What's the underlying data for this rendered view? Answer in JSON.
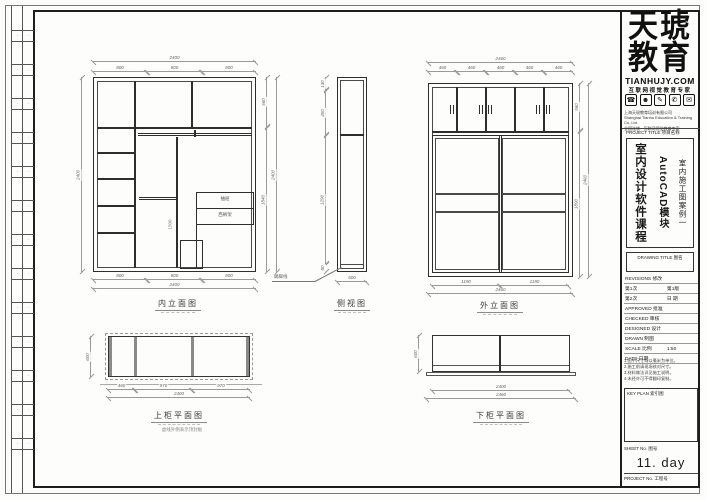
{
  "sheet": {
    "strip_mark": "·",
    "drawings": {
      "interior": {
        "label": "内立面图",
        "drawer": "抽屉",
        "rack": "西裤架",
        "dim_mid": "1500",
        "dim_top_total": "2400",
        "dim_top_segs": [
          "800",
          "800",
          "800"
        ],
        "dim_left_total": "2400",
        "dim_right_segs": [
          "560",
          "1840"
        ],
        "dim_right_total": "2400",
        "dim_bottom_segs": [
          "800",
          "800",
          "800"
        ],
        "dim_bottom_total": "2400"
      },
      "side": {
        "label": "侧视图",
        "note": "踢脚线",
        "dim_left_segs": [
          "130",
          "450",
          "1290",
          "80"
        ],
        "dim_bottom": "600"
      },
      "exterior": {
        "label": "外立面图",
        "dim_top_total": "2460",
        "dim_top_segs": [
          "460",
          "460",
          "460",
          "460",
          "460"
        ],
        "dim_right_segs": [
          "560",
          "1890"
        ],
        "dim_right_total": "2460",
        "dim_bottom_segs": [
          "1190",
          "1190"
        ],
        "dim_bottom_total": "2460"
      },
      "upper_plan": {
        "label": "上柜平面图",
        "note": "虚线外侧表示顶封板",
        "dim_left": "600",
        "dim_bottom_segs": [
          "460",
          "970",
          "970"
        ],
        "dim_bottom_total": "2400"
      },
      "lower_plan": {
        "label": "下柜平面图",
        "dim_left": "600",
        "dim_bottom_inner": "2400",
        "dim_bottom_total": "2460"
      }
    }
  },
  "titleblock": {
    "brand": {
      "line1": "天琥",
      "line2": "教育",
      "site": "TIANHUJY.COM",
      "tagline": "互联网视觉教育专家",
      "icons": [
        "☎",
        "☻",
        "✎",
        "✆",
        "✉"
      ],
      "company": [
        "上海天琥教育培训有限公司",
        "Shanghai Tianhu Education & Training Co.,Ltd.",
        "全国连锁 · 互联网视觉教育专家"
      ]
    },
    "project_title_label": "PROJECT TITLE 项目名称",
    "project_lines": [
      "室内设计软件课程",
      "AutoCAD模块",
      "室内施工图案例一"
    ],
    "drawing_title_label": "DRAWING TITLE 图名",
    "fields": [
      {
        "l": "REVISIONS 修改",
        "r": ""
      },
      {
        "l": "第1次",
        "r": "第1版"
      },
      {
        "l": "第2次",
        "r": "日 期"
      },
      {
        "l": "APPROVED 批准",
        "r": ""
      },
      {
        "l": "CHECKED 审核",
        "r": ""
      },
      {
        "l": "DESIGNED 设计",
        "r": ""
      },
      {
        "l": "DRAWN 制图",
        "r": ""
      },
      {
        "l": "SCALE 比例",
        "r": "1:50"
      },
      {
        "l": "DATE 日期",
        "r": ""
      }
    ],
    "notes": [
      "1.图中尺寸均以毫米为单位。",
      "2.施工前请现场核对尺寸。",
      "3.材料做法详见施工说明。",
      "4.未经许可不得翻印复制。"
    ],
    "key_plan_label": "KEY PLAN 索引图",
    "sheet_no_label": "SHEET No. 图号",
    "sheet_no_value": "11. day",
    "project_no_label": "PROJECT No. 工程号"
  }
}
